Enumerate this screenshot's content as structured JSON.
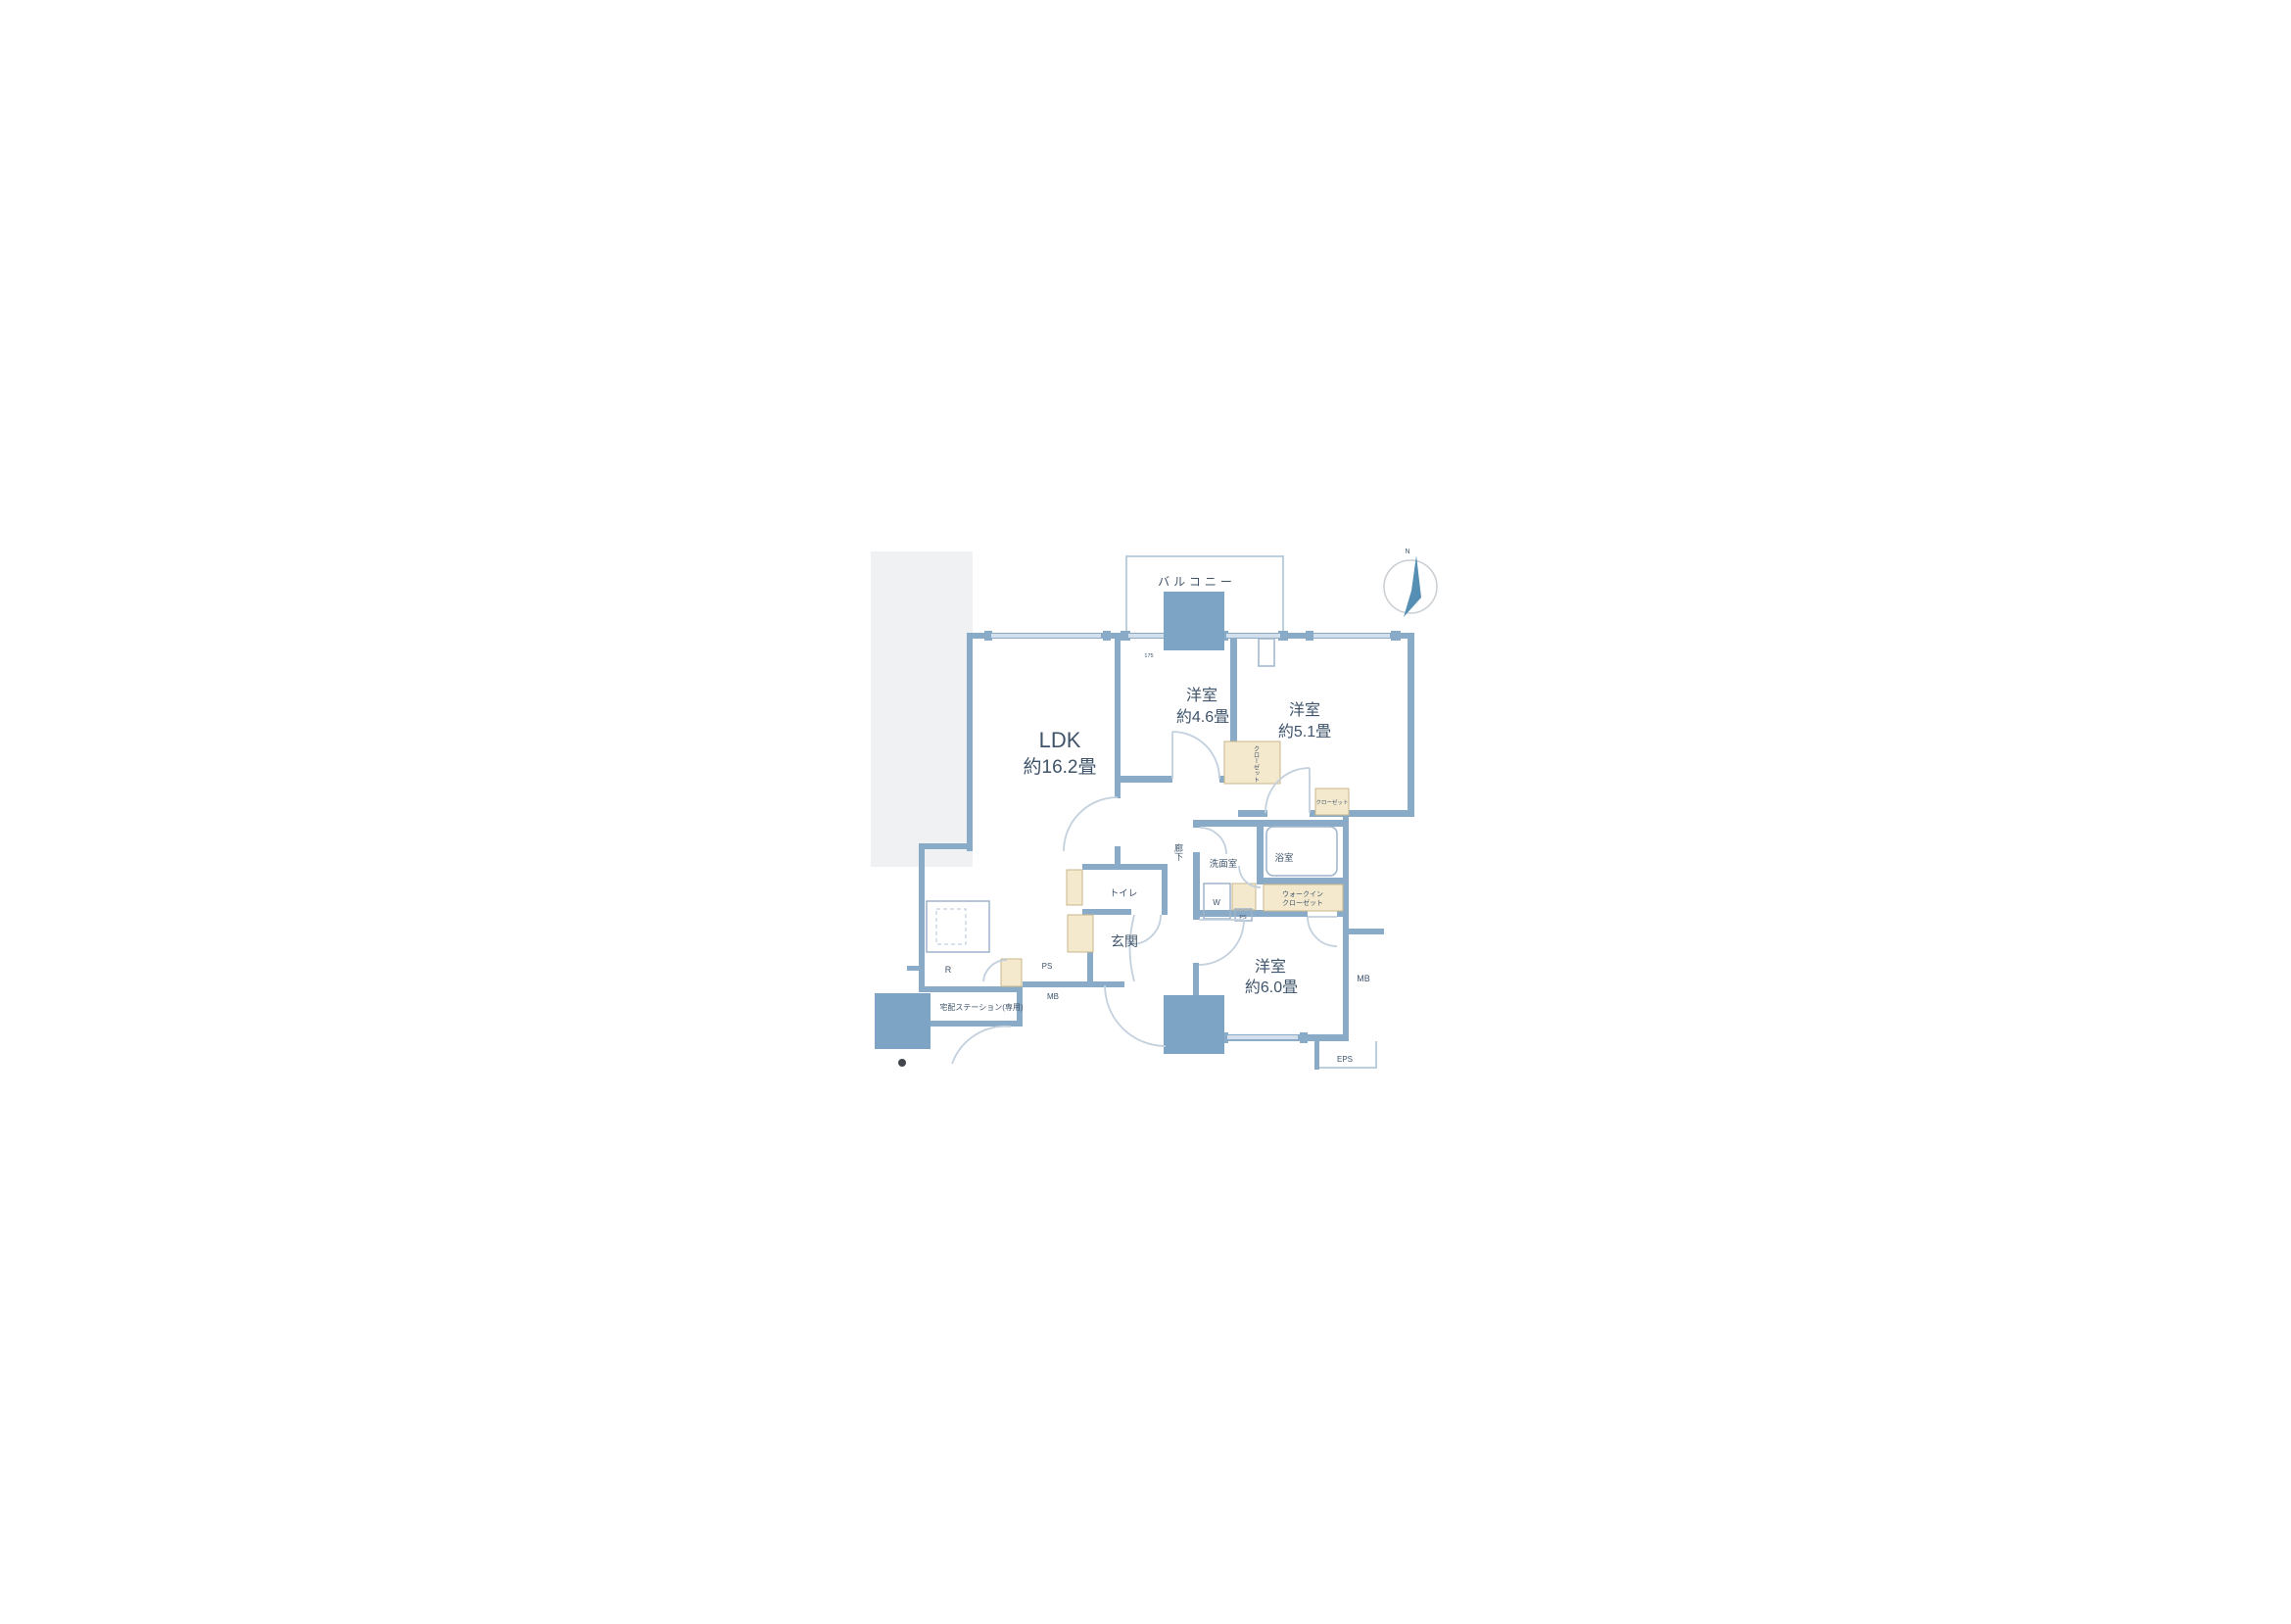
{
  "fp": {
    "balcony": "バルコニー",
    "compass_n": "N",
    "rooms": [
      {
        "name": "LDK",
        "size": "約16.2畳"
      },
      {
        "name": "洋室",
        "size": "約4.6畳"
      },
      {
        "name": "洋室",
        "size": "約5.1畳"
      },
      {
        "name": "洋室",
        "size": "約6.0畳"
      }
    ],
    "labels": {
      "toilet": "トイレ",
      "entrance": "玄関",
      "washroom": "洗面室",
      "bathroom": "浴室",
      "hallway": "廊下",
      "wic_line1": "ウォークイン",
      "wic_line2": "クローゼット",
      "closet": "クローゼット",
      "delivery": "宅配ステーション(専用)",
      "washer": "W",
      "refrigerator": "R",
      "pipe_space": "PS",
      "pipe_space_small": "PS",
      "meter_box_entrance": "MB",
      "meter_box_side": "MB",
      "eps": "EPS",
      "window_dim": "175"
    },
    "colors": {
      "wall": "#8aabc7",
      "pillar": "#7da4c4",
      "fixture_fill": "#f4e9cd",
      "fixture_border": "#c9b68c",
      "window": "#d3e0ec",
      "text": "#3f546b",
      "compass_needle": "#5590b4",
      "backdrop": "#eff1f2"
    }
  }
}
